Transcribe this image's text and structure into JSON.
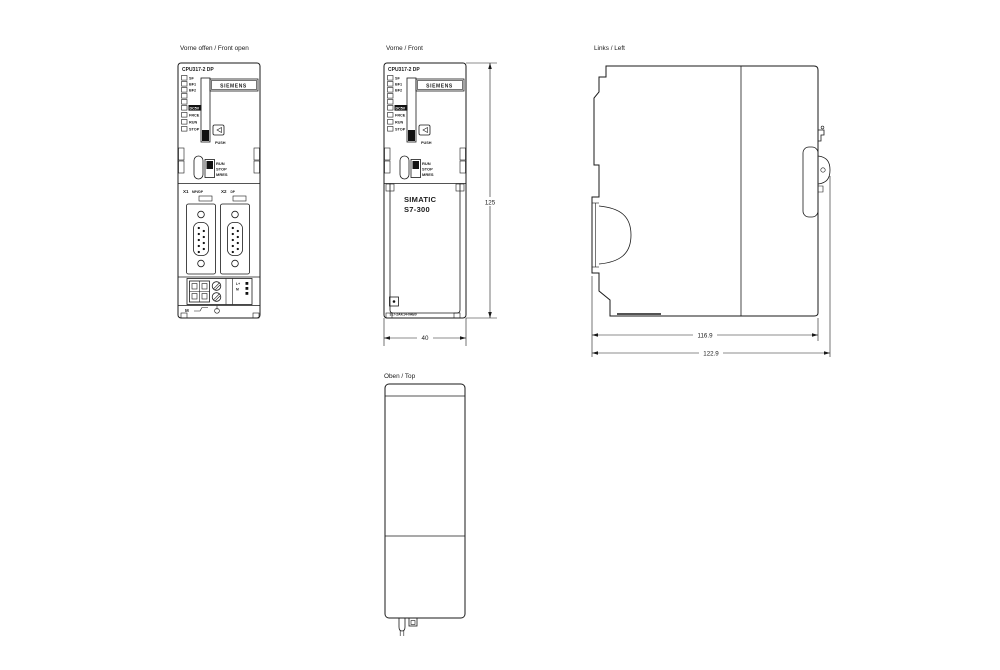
{
  "titles": {
    "front_open": "Vorne offen / Front open",
    "front": "Vorne / Front",
    "left": "Links / Left",
    "top": "Oben / Top"
  },
  "faceplate": {
    "header": "CPU317-2 DP",
    "brand": "SIEMENS",
    "leds": [
      "SF",
      "BF1",
      "BF2",
      "DC5V",
      "FRCE",
      "RUN",
      "STOP"
    ],
    "push": "PUSH",
    "mode_switch": [
      "RUN",
      "STOP",
      "MRES"
    ]
  },
  "front_open": {
    "port1": "X1",
    "port1_type": "MPI/DP",
    "port2": "X2",
    "port2_type": "DP",
    "terminal_lplus": "L+",
    "terminal_m": "M",
    "bottom_m": "M"
  },
  "front": {
    "product_line1": "SIMATIC",
    "product_line2": "S7-300",
    "order_number": "317-2AK14-0AB0"
  },
  "dimensions": {
    "height": "125",
    "width": "40",
    "depth_body": "116.9",
    "depth_total": "122.9"
  },
  "colors": {
    "line": "#1a1a1a",
    "background": "#ffffff"
  }
}
